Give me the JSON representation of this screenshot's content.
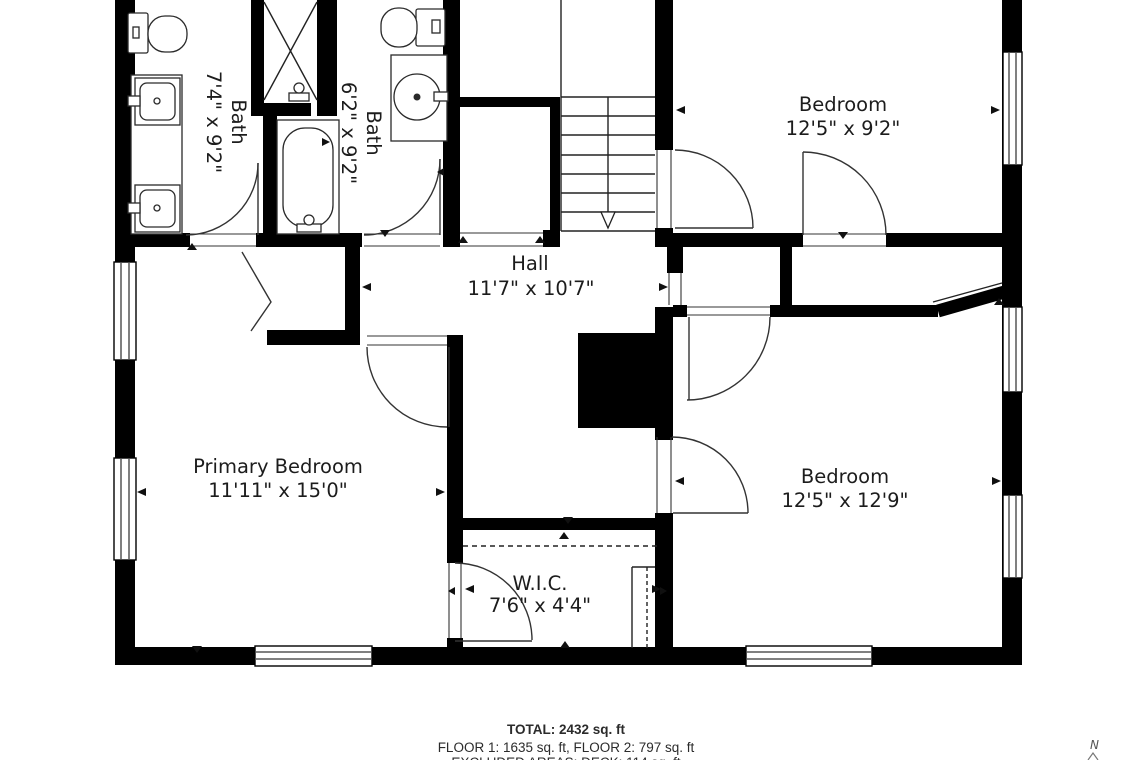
{
  "floorplan": {
    "rooms": [
      {
        "id": "bath-1",
        "name": "Bath",
        "dims": "7'4\" x 9'2\""
      },
      {
        "id": "bath-2",
        "name": "Bath",
        "dims": "6'2\" x 9'2\""
      },
      {
        "id": "bedroom-top-right",
        "name": "Bedroom",
        "dims": "12'5\" x 9'2\""
      },
      {
        "id": "hall",
        "name": "Hall",
        "dims": "11'7\" x 10'7\""
      },
      {
        "id": "primary-bedroom",
        "name": "Primary Bedroom",
        "dims": "11'11\" x 15'0\""
      },
      {
        "id": "bedroom-bottom-right",
        "name": "Bedroom",
        "dims": "12'5\" x 12'9\""
      },
      {
        "id": "wic",
        "name": "W.I.C.",
        "dims": "7'6\" x 4'4\""
      }
    ],
    "compass": {
      "north_label": "N"
    }
  },
  "footer": {
    "total": "TOTAL: 2432 sq. ft",
    "floors": "FLOOR 1: 1635 sq. ft, FLOOR 2: 797 sq. ft",
    "excluded": "EXCLUDED AREAS: DECK: 114 sq. ft"
  },
  "colors": {
    "wall": "#000000",
    "line": "#2a2a2a",
    "text": "#1c1c1c",
    "background": "#ffffff"
  }
}
